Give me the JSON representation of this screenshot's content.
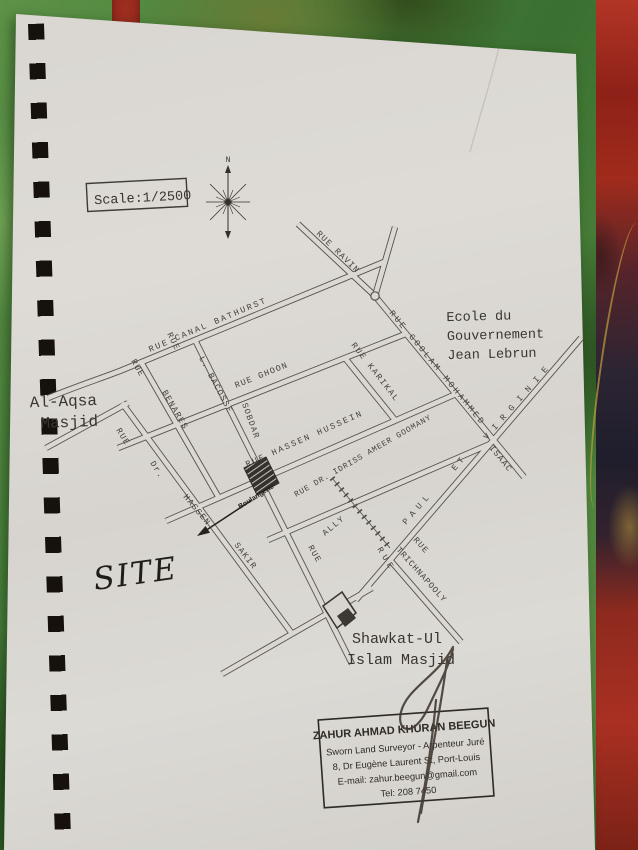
{
  "map": {
    "scale_label": "Scale:1/2500",
    "compass_north": "N",
    "street_labels": [
      {
        "name": "rue-ravin",
        "text": "RUE RAVIN"
      },
      {
        "name": "rue-goolam-mohammed",
        "text": "RUE GOOLAM MOHAMMED"
      },
      {
        "name": "rue-canal-bathurst",
        "text": "RUE CANAL BATHURST"
      },
      {
        "name": "rue-fragment",
        "text": "RUE"
      },
      {
        "name": "rue-benares-prefix",
        "text": "RUE"
      },
      {
        "name": "rue-benares",
        "text": "BENARES"
      },
      {
        "name": "rue-l-bacosse",
        "text": "L. BACOSSE"
      },
      {
        "name": "rue-ghoon",
        "text": "RUE GHOON"
      },
      {
        "name": "rue-sobdar",
        "text": "SOBDAR"
      },
      {
        "name": "rue-hassen-hussein",
        "text": "RUE HASSEN HUSSEIN"
      },
      {
        "name": "rue-karikal",
        "text": "RUE KARIKAL"
      },
      {
        "name": "rue-dr-idriss-ameer-goomany",
        "text": "RUE DR. IDRISS AMEER GOOMANY"
      },
      {
        "name": "rue-ally-prefix",
        "text": "RUE"
      },
      {
        "name": "rue-ally",
        "text": "ALLY"
      },
      {
        "name": "rue-paul-prefix",
        "text": "RUE"
      },
      {
        "name": "rue-paul",
        "text": "PAUL"
      },
      {
        "name": "rue-et",
        "text": "ET"
      },
      {
        "name": "rue-virginie",
        "text": "VIRGINIE"
      },
      {
        "name": "rue-isaac",
        "text": "ISAAC"
      },
      {
        "name": "rue-trichnapooly-prefix",
        "text": "RUE"
      },
      {
        "name": "rue-trichnapooly",
        "text": "TRICHNAPOOLY"
      },
      {
        "name": "rue-dr-hassen-sakir-prefix",
        "text": "RUE"
      },
      {
        "name": "rue-dr",
        "text": "Dr."
      },
      {
        "name": "rue-hassen",
        "text": "HASSEN"
      },
      {
        "name": "rue-sakir",
        "text": "SAKIR"
      }
    ],
    "places": {
      "ecole_line1": "Ecole du",
      "ecole_line2": "Gouvernement",
      "ecole_line3": "Jean Lebrun",
      "alaqsa_line1": "Al-Aqsa",
      "alaqsa_line2": "Masjid",
      "shawkat_line1": "Shawkat-Ul",
      "shawkat_line2": "Islam Masjid",
      "site": "SITE",
      "boulangerie": "Boulangerie"
    },
    "stamp": {
      "name": "ZAHUR AHMAD KHURAN BEEGUN",
      "title": "Sworn Land Surveyor - Arpenteur Juré",
      "address": "8, Dr Eugène Laurent St, Port-Louis",
      "email": "E-mail: zahur.beegun@gmail.com",
      "tel": "Tel: 208 7450"
    }
  }
}
